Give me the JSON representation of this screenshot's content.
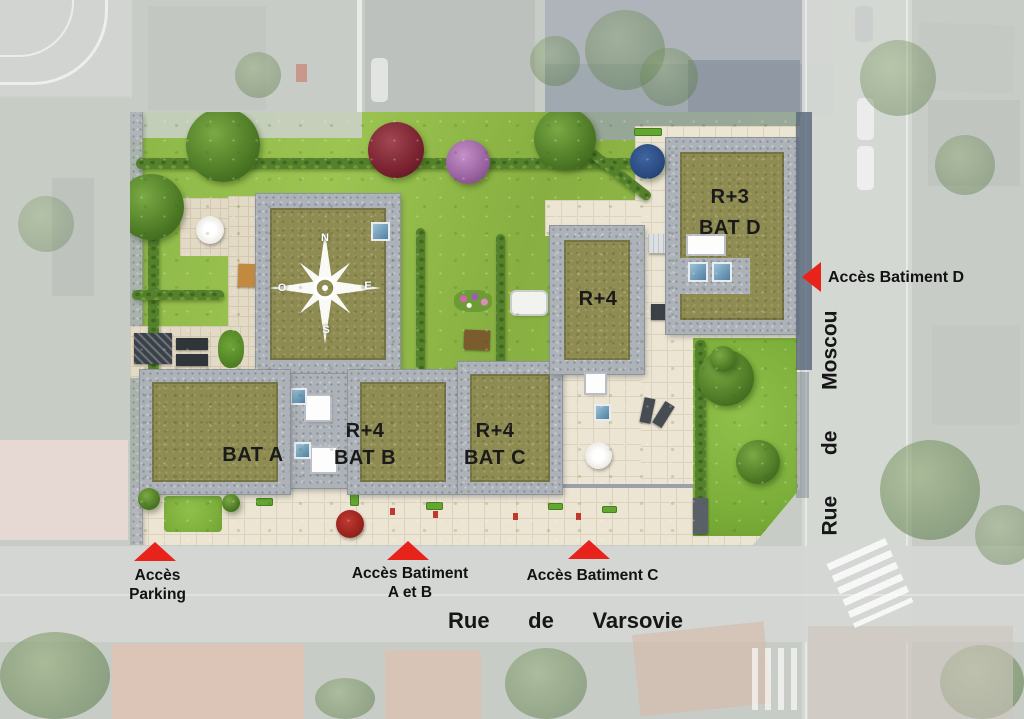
{
  "plan": {
    "buildings": {
      "bat_a": {
        "name": "BAT A"
      },
      "bat_b": {
        "floors": "R+4",
        "name": "BAT B"
      },
      "bat_c": {
        "floors": "R+4",
        "name": "BAT C"
      },
      "bat_center": {
        "floors": "R+4"
      },
      "bat_d": {
        "floors": "R+3",
        "name": "BAT D"
      }
    },
    "compass": {
      "north": "N",
      "east": "E",
      "south": "S",
      "west": "O"
    },
    "access_points": {
      "parking": {
        "line1": "Accès",
        "line2": "Parking"
      },
      "bat_ab": {
        "line1": "Accès Batiment",
        "line2": "A et B"
      },
      "bat_c": {
        "line1": "Accès Batiment C"
      },
      "bat_d": {
        "line1": "Accès Batiment D"
      }
    },
    "streets": {
      "varsovie": {
        "word1": "Rue",
        "word2": "de",
        "word3": "Varsovie"
      },
      "moscou": {
        "word1": "Rue",
        "word2": "de",
        "word3": "Moscou"
      }
    },
    "palette": {
      "accent_red": "#e8231b",
      "lawn_green": "#8db648",
      "roof_khaki": "#8e8c53",
      "gravel_gray": "#adb2b8",
      "paving_cream": "#ece5d3",
      "label_text": "#1a1a1a"
    }
  }
}
